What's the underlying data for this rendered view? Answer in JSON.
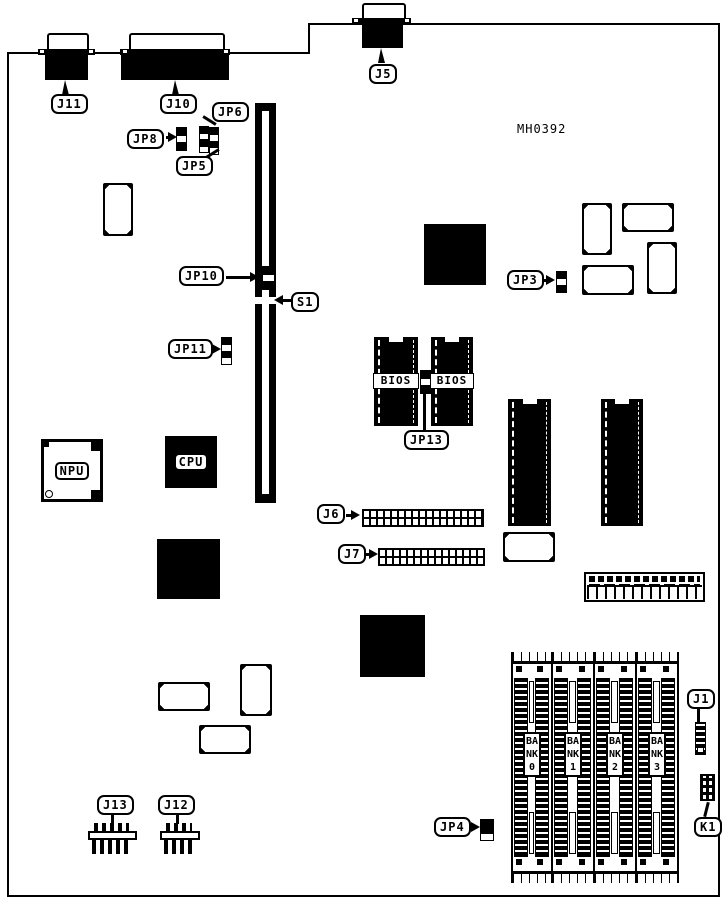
{
  "board": {
    "part_number": "MH0392"
  },
  "callouts": {
    "j11": "J11",
    "j10": "J10",
    "j5": "J5",
    "jp8": "JP8",
    "jp6": "JP6",
    "jp5": "JP5",
    "jp10": "JP10",
    "s1": "S1",
    "jp11": "JP11",
    "jp3": "JP3",
    "jp13": "JP13",
    "j6": "J6",
    "j7": "J7",
    "j13": "J13",
    "j12": "J12",
    "jp4": "JP4",
    "j1": "J1",
    "k1": "K1",
    "npu": "NPU",
    "cpu": "CPU",
    "bios": "BIOS"
  },
  "banks": [
    {
      "label": "BANK0"
    },
    {
      "label": "BANK1"
    },
    {
      "label": "BANK2"
    },
    {
      "label": "BANK3"
    }
  ],
  "colors": {
    "ink": "#000000",
    "paper": "#ffffff"
  }
}
